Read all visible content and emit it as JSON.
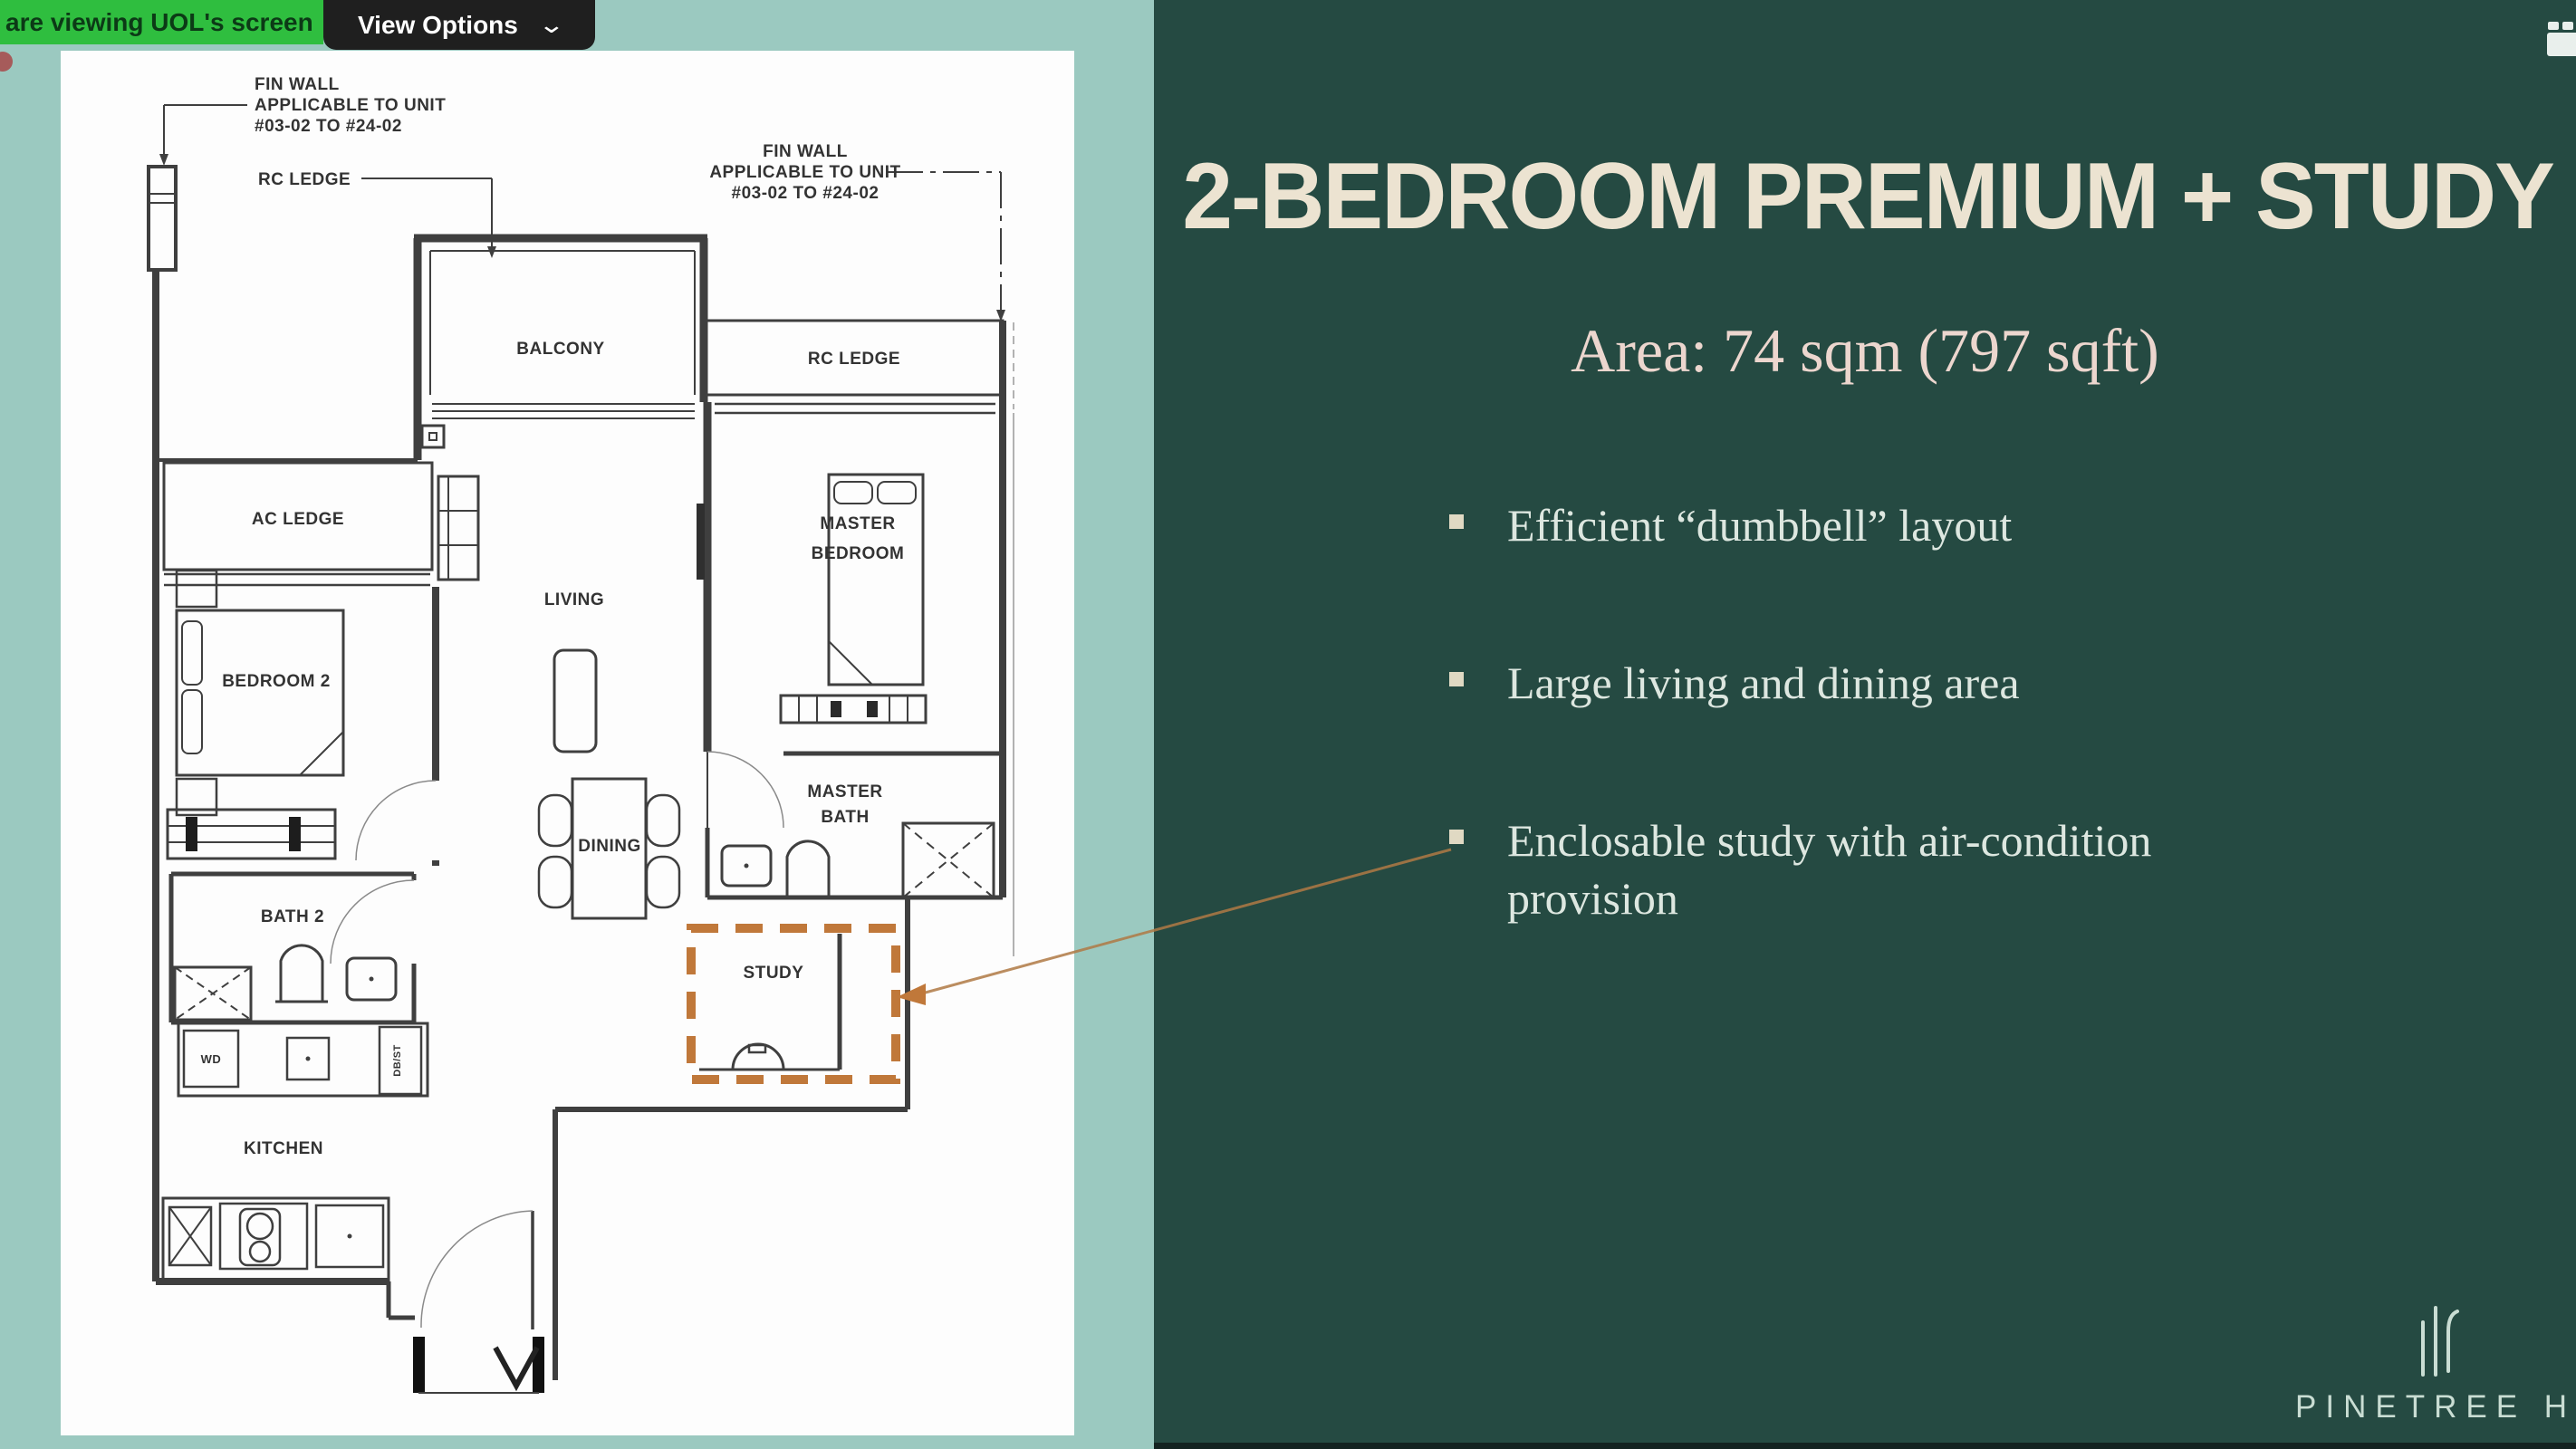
{
  "meeting": {
    "banner_text": "are viewing UOL's screen",
    "view_options_label": "View Options",
    "chevron": "⌄"
  },
  "slide": {
    "title": "2-BEDROOM PREMIUM + STUDY",
    "area_line": "Area: 74 sqm (797 sqft)",
    "bullets": [
      "Efficient “dumbbell” layout",
      "Large living and dining area",
      "Enclosable study with air-condition provision"
    ],
    "logo_text": "PINETREE HILL"
  },
  "floor_plan": {
    "labels": {
      "fin_wall_left_1": "FIN WALL",
      "fin_wall_left_2": "APPLICABLE TO UNIT",
      "fin_wall_left_3": "#03-02 TO #24-02",
      "rc_ledge_left": "RC LEDGE",
      "fin_wall_right_1": "FIN WALL",
      "fin_wall_right_2": "APPLICABLE TO UNIT",
      "fin_wall_right_3": "#03-02 TO #24-02",
      "rc_ledge_right": "RC LEDGE",
      "balcony": "BALCONY",
      "ac_ledge": "AC LEDGE",
      "living": "LIVING",
      "master_bedroom_1": "MASTER",
      "master_bedroom_2": "BEDROOM",
      "bedroom_2": "BEDROOM 2",
      "dining": "DINING",
      "master_bath_1": "MASTER",
      "master_bath_2": "BATH",
      "bath_2": "BATH 2",
      "study": "STUDY",
      "kitchen": "KITCHEN",
      "wd": "WD",
      "db_st": "DB/ST"
    }
  },
  "colors": {
    "page_background": "#9bc9c0",
    "panel_background": "#254a42",
    "banner_green": "#2fbe3f",
    "title_cream": "#ece3d1",
    "area_pink_cream": "#ecd6ce",
    "bullet_text": "#dde7e0",
    "highlight_orange": "#c0783a",
    "plan_line": "#3f3f3f"
  },
  "icons": {
    "view_options_chevron": "chevron-down",
    "corner_icon": "video-app-icon",
    "study_highlight": "dashed-orange-rectangle",
    "study_callout": "orange-connector-arrow"
  }
}
